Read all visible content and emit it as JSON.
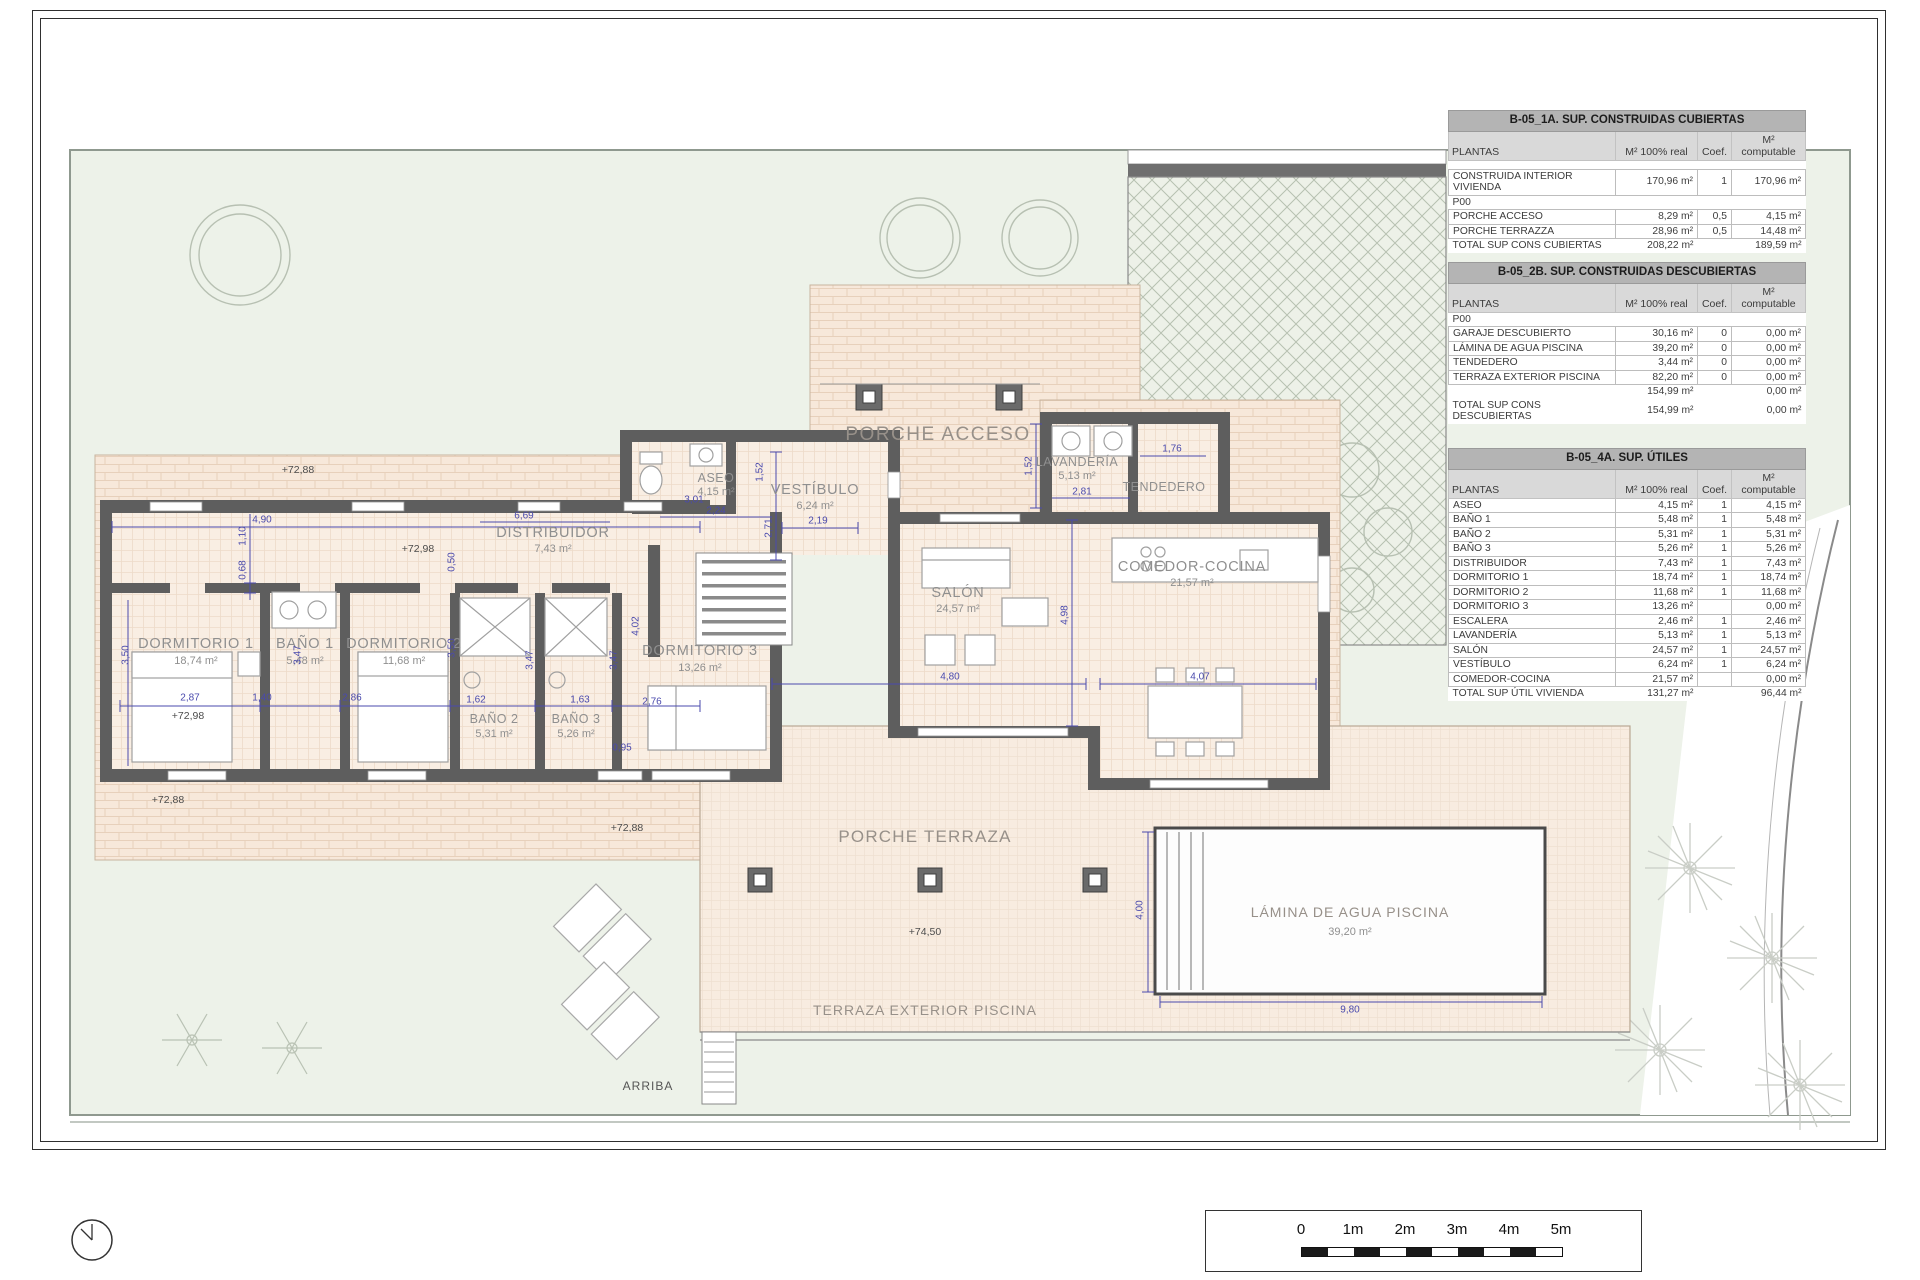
{
  "plan": {
    "rooms": [
      {
        "name": "DORMITORIO 1",
        "area": "18,74 m²"
      },
      {
        "name": "BAÑO 1",
        "area": "5,48 m²"
      },
      {
        "name": "DORMITORIO 2",
        "area": "11,68 m²"
      },
      {
        "name": "BAÑO 2",
        "area": "5,31 m²"
      },
      {
        "name": "BAÑO 3",
        "area": "5,26 m²"
      },
      {
        "name": "DORMITORIO 3",
        "area": "13,26 m²"
      },
      {
        "name": "DISTRIBUIDOR",
        "area": "7,43 m²"
      },
      {
        "name": "ASEO",
        "area": "4,15 m²"
      },
      {
        "name": "VESTÍBULO",
        "area": "6,24 m²"
      },
      {
        "name": "LAVANDERÍA",
        "area": "5,13 m²"
      },
      {
        "name": "TENDEDERO",
        "area": ""
      },
      {
        "name": "SALÓN",
        "area": "24,57 m²"
      },
      {
        "name": "COMEDOR-COCINA",
        "area": "21,57 m²"
      }
    ],
    "outdoor": {
      "porche_acceso": "PORCHE ACCESO",
      "porche_terraza": "PORCHE TERRAZA",
      "terraza_exterior": "TERRAZA EXTERIOR PISCINA",
      "pool_name": "LÁMINA DE AGUA PISCINA",
      "pool_area": "39,20 m²",
      "arriba": "ARRIBA"
    },
    "levels": [
      "+72,88",
      "+72,98",
      "+72,98",
      "+72,88",
      "+72,88",
      "+74,50"
    ],
    "dims": [
      "4,90",
      "1,10",
      "0,68",
      "0,50",
      "6,69",
      "3,01",
      "1,52",
      "2,71",
      "2,19",
      "1,52",
      "2,81",
      "1,76",
      "2,87",
      "1,40",
      "2,86",
      "1,62",
      "1,63",
      "2,76",
      "0,95",
      "3,50",
      "3,47",
      "3,50",
      "3,47",
      "3,47",
      "4,02",
      "4,80",
      "4,07",
      "4,98",
      "4,00",
      "9,80",
      "2,24"
    ]
  },
  "tables": [
    {
      "title": "B-05_1A. SUP. CONSTRUIDAS CUBIERTAS",
      "columns": [
        "PLANTAS",
        "M² 100% real",
        "Coef.",
        "M² computable"
      ],
      "rows": [
        [
          "CONSTRUIDA INTERIOR VIVIENDA",
          "170,96 m²",
          "1",
          "170,96 m²"
        ],
        [
          "P00",
          "",
          "",
          ""
        ],
        [
          "PORCHE ACCESO",
          "8,29 m²",
          "0,5",
          "4,15 m²"
        ],
        [
          "PORCHE TERRAZZA",
          "28,96 m²",
          "0,5",
          "14,48 m²"
        ],
        [
          "TOTAL SUP CONS CUBIERTAS",
          "208,22 m²",
          "",
          "189,59 m²"
        ]
      ]
    },
    {
      "title": "B-05_2B. SUP. CONSTRUIDAS DESCUBIERTAS",
      "columns": [
        "PLANTAS",
        "M² 100% real",
        "Coef.",
        "M² computable"
      ],
      "rows": [
        [
          "P00",
          "",
          "",
          ""
        ],
        [
          "GARAJE DESCUBIERTO",
          "30,16 m²",
          "0",
          "0,00 m²"
        ],
        [
          "LÁMINA DE AGUA PISCINA",
          "39,20 m²",
          "0",
          "0,00 m²"
        ],
        [
          "TENDEDERO",
          "3,44 m²",
          "0",
          "0,00 m²"
        ],
        [
          "TERRAZA EXTERIOR PISCINA",
          "82,20 m²",
          "0",
          "0,00 m²"
        ],
        [
          "",
          "154,99 m²",
          "",
          "0,00 m²"
        ],
        [
          "TOTAL SUP CONS DESCUBIERTAS",
          "154,99 m²",
          "",
          "0,00 m²"
        ]
      ]
    },
    {
      "title": "B-05_4A. SUP. ÚTILES",
      "columns": [
        "PLANTAS",
        "M² 100% real",
        "Coef.",
        "M² computable"
      ],
      "rows": [
        [
          "ASEO",
          "4,15 m²",
          "1",
          "4,15 m²"
        ],
        [
          "BAÑO 1",
          "5,48 m²",
          "1",
          "5,48 m²"
        ],
        [
          "BAÑO 2",
          "5,31 m²",
          "1",
          "5,31 m²"
        ],
        [
          "BAÑO 3",
          "5,26 m²",
          "1",
          "5,26 m²"
        ],
        [
          "DISTRIBUIDOR",
          "7,43 m²",
          "1",
          "7,43 m²"
        ],
        [
          "DORMITORIO 1",
          "18,74 m²",
          "1",
          "18,74 m²"
        ],
        [
          "DORMITORIO 2",
          "11,68 m²",
          "1",
          "11,68 m²"
        ],
        [
          "DORMITORIO 3",
          "13,26 m²",
          "",
          "0,00 m²"
        ],
        [
          "ESCALERA",
          "2,46 m²",
          "1",
          "2,46 m²"
        ],
        [
          "LAVANDERÍA",
          "5,13 m²",
          "1",
          "5,13 m²"
        ],
        [
          "SALÓN",
          "24,57 m²",
          "1",
          "24,57 m²"
        ],
        [
          "VESTÍBULO",
          "6,24 m²",
          "1",
          "6,24 m²"
        ],
        [
          "COMEDOR-COCINA",
          "21,57 m²",
          "",
          "0,00 m²"
        ],
        [
          "TOTAL SUP ÚTIL VIVIENDA",
          "131,27 m²",
          "",
          "96,44 m²"
        ]
      ]
    }
  ],
  "scale_bar": {
    "labels": [
      "0",
      "1m",
      "2m",
      "3m",
      "4m",
      "5m"
    ]
  },
  "colors": {
    "wall": "#5e5e5e",
    "dimension": "#4a4aad",
    "paving": "#f7e8da",
    "garden": "#edf2e9",
    "label": "#8f8f8f"
  }
}
